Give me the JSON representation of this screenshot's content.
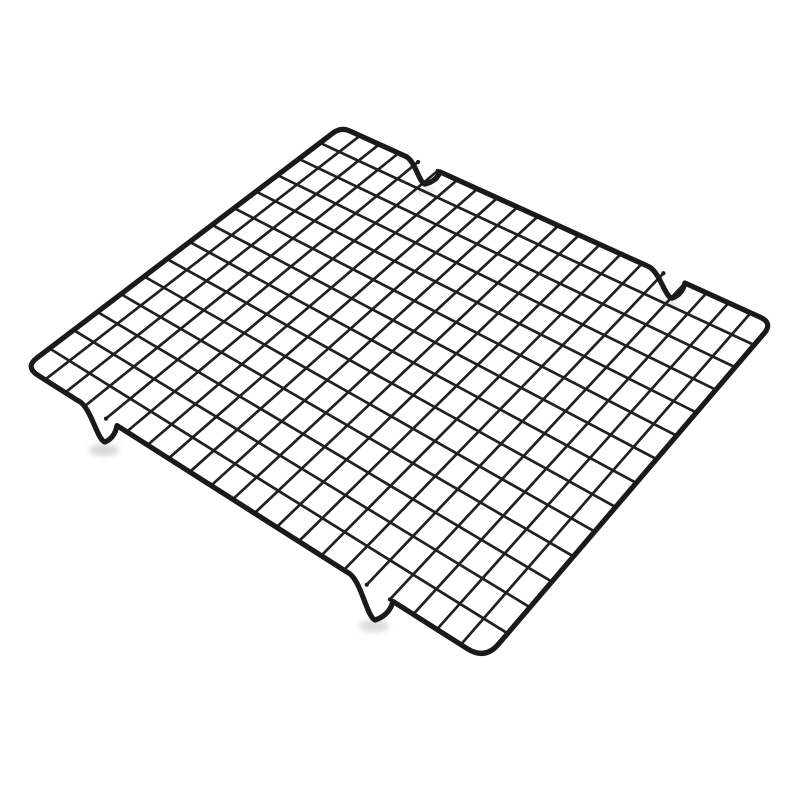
{
  "image": {
    "type": "product-photo",
    "subject": "Black metal wire grid cooling rack (baking rack) photographed at an angle on a plain white background",
    "visible_text": "",
    "background_color": "#ffffff"
  },
  "rack": {
    "wire_color": "#1a1a1a",
    "grid_wire_color": "#202020",
    "shadow_color": "#8f8f8f",
    "frame_stroke_width": 5.2,
    "grid_stroke_width": 2.7,
    "weld_dot_radius": 2.1,
    "grid_columns": 21,
    "grid_rows": 14,
    "perspective_blend": 0.5,
    "corners": {
      "top": {
        "x": 341,
        "y": 127,
        "radius": 10
      },
      "right": {
        "x": 773,
        "y": 323,
        "radius": 14
      },
      "bottom": {
        "x": 485,
        "y": 660,
        "radius": 21
      },
      "left": {
        "x": 25,
        "y": 367,
        "radius": 15
      }
    },
    "feet_notches": [
      {
        "edge": "top",
        "t1": 0.148,
        "t2": 0.229,
        "depth": 19,
        "bottom_bias": 0.57
      },
      {
        "edge": "top",
        "t1": 0.708,
        "t2": 0.796,
        "depth": 21,
        "bottom_bias": 0.66
      },
      {
        "edge": "bottom",
        "t1": 0.113,
        "t2": 0.2,
        "depth": 24,
        "bottom_bias": 0.7
      },
      {
        "edge": "bottom",
        "t1": 0.7,
        "t2": 0.8,
        "depth": 30,
        "bottom_bias": 0.61
      }
    ],
    "shadows": [
      {
        "cx": 104,
        "cy": 450,
        "rx": 15,
        "ry": 6,
        "opacity": 0.35
      },
      {
        "cx": 374,
        "cy": 626,
        "rx": 15,
        "ry": 6,
        "opacity": 0.32
      },
      {
        "cx": 424,
        "cy": 191,
        "rx": 10,
        "ry": 4,
        "opacity": 0.22
      },
      {
        "cx": 669,
        "cy": 303,
        "rx": 10,
        "ry": 4,
        "opacity": 0.22
      }
    ]
  }
}
